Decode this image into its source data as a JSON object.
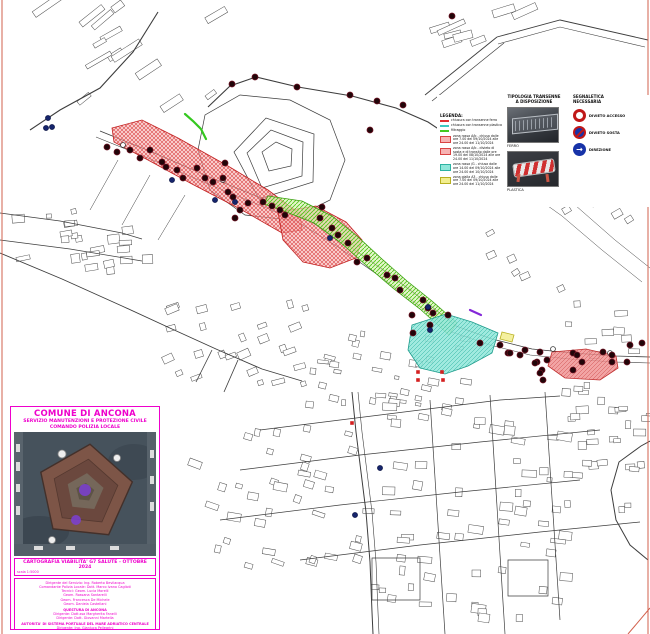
{
  "colors": {
    "magenta": "#ee00cc",
    "zone_red_hatch": "#d94343",
    "zone_green_hatch": "#55c41c",
    "zone_cyan": "#2db3a2",
    "zone_yellow": "#d8c820",
    "barrier_dot": "#210509",
    "blue_dot": "#15246b",
    "frame": "#d2604c"
  },
  "legend": {
    "col1_header": "TIPOLOGIA TRANSENNE\nA DISPOSIZIONE",
    "col2_header": "SEGNALETICA\nNECESSARIA",
    "list_title": "LEGENDA:",
    "items": [
      {
        "kind": "line",
        "color": "#e03030",
        "label": "chiusura con transenne ferro"
      },
      {
        "kind": "line",
        "color": "#3ec8c0",
        "label": "chiusura con transenne plastica"
      },
      {
        "kind": "line",
        "color": "#44c820",
        "label": "filtraggio"
      },
      {
        "kind": "zone",
        "color": "#f7b3b3",
        "border": "#d94343",
        "label": "zona rossa A/b - chiusa dalle ore 7.00 del 09/10/2024 alle ore 24.00 del 11/10/2024"
      },
      {
        "kind": "zone",
        "color": "#f7b3b3",
        "border": "#d94343",
        "label": "zona rossa A/b - divieto di sosta e di transito dalle ore 19.00 del 08/10/2024 alle ore 24.00 del 11/10/2024"
      },
      {
        "kind": "zone",
        "color": "#8fe7da",
        "border": "#2db3a2",
        "label": "zona rossa /G - chiusa dalle ore 14.00 del 09/10/2024 alle ore 24.00 del 10/10/2024"
      },
      {
        "kind": "zone",
        "color": "#f2ee8e",
        "border": "#b8b020",
        "label": "zona gialla A3 - chiusa dalle ore 7.00 del 09/10/2024 alle ore 24.00 del 11/10/2024"
      }
    ],
    "photos": [
      {
        "label": "FERRO"
      },
      {
        "label": "PLASTICA"
      }
    ],
    "signs": [
      {
        "name": "divieto-accesso",
        "label": "DIVIETO ACCESSO"
      },
      {
        "name": "divieto-sosta",
        "label": "DIVIETO SOSTA"
      },
      {
        "name": "direzione",
        "label": "DIREZIONE"
      }
    ]
  },
  "title_box": {
    "line1": "COMUNE DI ANCONA",
    "line2": "SERVIZIO MANUTENZIONI E PROTEZIONE CIVILE",
    "line3": "COMANDO POLIZIA LOCALE",
    "caption": "CARTOGRAFIA VIABILITA' G7 SALUTE - OTTOBRE 2024",
    "scale": "scala 1:5000",
    "credits": [
      {
        "text": "Dirigente del Servizio: Ing. Roberto Bevilacqua",
        "bold": false
      },
      {
        "text": "Comandante Polizia Locale: Dott. Marco Ivano Caglioti",
        "bold": false
      },
      {
        "text": "Tecnici: Geom. Lucia Morelli",
        "bold": false
      },
      {
        "text": "Geom. Rossana Santarelli",
        "bold": false
      },
      {
        "text": "Geom. Francesca De Michele",
        "bold": false
      },
      {
        "text": "Geom. Daniela Castellani",
        "bold": false
      },
      {
        "text": "QUESTURA DI ANCONA",
        "bold": true
      },
      {
        "text": "Dirigente: Dott.ssa Margherita Fanelli",
        "bold": false
      },
      {
        "text": "Dirigente: Dott. Giovanni Martella",
        "bold": false
      },
      {
        "text": "AUTORITA' DI SISTEMA PORTUALE DEL MARE ADRIATICO CENTRALE",
        "bold": true
      },
      {
        "text": "Dirigente: Ing. Gianluca Pellegrini",
        "bold": false
      },
      {
        "text": "Tecnico: Geom. Marco Bragagnolo",
        "bold": false
      }
    ]
  },
  "map": {
    "zones": [
      {
        "name": "zona-rossa-a",
        "pattern": "patRed",
        "stroke": "#c22020",
        "points": "112,128 142,120 178,138 228,166 268,190 300,214 302,230 282,233 242,210 192,184 148,160 114,142"
      },
      {
        "name": "zona-rossa-b",
        "pattern": "patRed",
        "stroke": "#c22020",
        "points": "278,212 316,206 346,222 362,240 356,258 330,268 303,262 283,240"
      },
      {
        "name": "zona-verde",
        "pattern": "patGreen",
        "stroke": "#3aa010",
        "points": "268,196 302,201 332,216 357,236 382,259 407,281 432,301 457,323 449,335 420,309 394,289 367,266 341,243 314,223 284,211 264,204"
      },
      {
        "name": "zona-rossa-g-cyan",
        "pattern": "patCyan",
        "stroke": "#1f9c8c",
        "points": "412,325 446,314 472,322 498,333 492,353 468,366 445,374 420,368 408,350"
      },
      {
        "name": "zona-rossa-destra",
        "pattern": "patRedSolid",
        "stroke": "#c03030",
        "points": "552,352 586,349 616,356 618,368 600,380 565,378 548,366"
      },
      {
        "name": "zona-gialla",
        "pattern": "patYellow",
        "stroke": "#b8b020",
        "points": "502,332 514,335 512,342 500,339"
      }
    ],
    "roads": [
      {
        "points": "30,130 60,110 100,88 133,52 158,12",
        "w": 1.1
      },
      {
        "points": "208,107 230,86 256,77 298,87 352,96 396,108 428,122 458,142 472,162",
        "w": 1.1
      },
      {
        "points": "100,131 152,152 212,178 266,200 302,216",
        "w": 0.8
      },
      {
        "points": "96,137 148,158 208,184 262,206 298,222",
        "w": 0.6
      },
      {
        "points": "302,216 342,241 382,269 422,299 456,326 492,339 532,349 572,353 616,356 650,357",
        "w": 0.8
      },
      {
        "points": "298,222 338,247 378,275 418,305 452,332 490,345 530,355 570,359 614,362 650,363",
        "w": 0.6
      },
      {
        "points": "0,253 62,279 122,306 172,329 216,349 262,369 302,381",
        "w": 0.9
      },
      {
        "points": "212,350 196,382",
        "w": 0.8
      },
      {
        "points": "238,360 224,392",
        "w": 0.8
      },
      {
        "points": "648,560 630,545 616,520 611,490 619,462 641,446 650,441",
        "w": 1
      },
      {
        "points": "352,392 356,432 361,472 366,512 370,562 372,612 373,634",
        "w": 1
      },
      {
        "points": "358,392 362,432 367,472 372,512 376,562 378,612 379,634",
        "w": 0.6
      },
      {
        "points": "260,430 380,415 500,400 560,396",
        "w": 0.7
      },
      {
        "points": "240,470 360,455 480,442 600,430",
        "w": 0.7
      },
      {
        "points": "220,520 340,505 460,492 580,480",
        "w": 0.7
      },
      {
        "points": "300,560 420,545 540,532 640,522",
        "w": 0.7
      },
      {
        "points": "430,400 445,634",
        "w": 0.7
      },
      {
        "points": "490,395 505,634",
        "w": 0.7
      },
      {
        "points": "545,392 560,620",
        "w": 0.7
      },
      {
        "points": "0,213 60,221 122,233 142,239",
        "w": 0.7
      },
      {
        "points": "0,240 70,249 142,261",
        "w": 0.7
      },
      {
        "points": "470,162 520,186 562,216 602,250 642,282",
        "w": 0.5
      },
      {
        "points": "480,150 530,175 575,205 615,240 650,268",
        "w": 0.5
      },
      {
        "points": "425,95 497,37",
        "w": 0.9
      },
      {
        "points": "432,101 504,43",
        "w": 0.7
      },
      {
        "points": "497,37 560,20 648,40",
        "w": 0.9
      },
      {
        "points": "498,44 560,27 645,47",
        "w": 0.6
      },
      {
        "points": "118,160 90,210",
        "w": 0.5
      },
      {
        "points": "150,175 122,225",
        "w": 0.5
      },
      {
        "points": "185,195 158,240",
        "w": 0.5
      }
    ],
    "outlines": [
      {
        "points": "234,152 266,118 314,134 313,182 259,199"
      },
      {
        "points": "247,153 271,130 303,142 302,176 262,188"
      },
      {
        "points": "262,152 276,142 292,149 291,166 269,171"
      },
      {
        "points": "198,150 205,115 240,95 290,100 330,120 345,160 330,200 290,220 245,215 210,190 198,150"
      },
      {
        "points": "508,560 548,560 548,596 508,596 508,560"
      },
      {
        "points": "372,558 420,558 420,600 372,600 372,558"
      }
    ],
    "green_lines": [
      "185,114 193,121 201,129 206,139"
    ],
    "purple_lines": [
      "470,310 481,315"
    ],
    "frame_lines": [
      [
        2,
        0,
        2,
        634
      ],
      [
        648,
        0,
        648,
        634
      ],
      [
        650,
        608,
        628,
        634
      ]
    ],
    "dots": {
      "barrier": [
        [
          107,
          147
        ],
        [
          117,
          152
        ],
        [
          130,
          150
        ],
        [
          140,
          158
        ],
        [
          150,
          150
        ],
        [
          162,
          162
        ],
        [
          166,
          167
        ],
        [
          177,
          170
        ],
        [
          183,
          178
        ],
        [
          197,
          168
        ],
        [
          205,
          178
        ],
        [
          213,
          182
        ],
        [
          225,
          163
        ],
        [
          223,
          178
        ],
        [
          228,
          192
        ],
        [
          233,
          197
        ],
        [
          240,
          210
        ],
        [
          248,
          203
        ],
        [
          263,
          202
        ],
        [
          272,
          206
        ],
        [
          280,
          210
        ],
        [
          235,
          218
        ],
        [
          285,
          215
        ],
        [
          322,
          207
        ],
        [
          320,
          218
        ],
        [
          332,
          228
        ],
        [
          338,
          235
        ],
        [
          348,
          243
        ],
        [
          357,
          262
        ],
        [
          367,
          258
        ],
        [
          387,
          275
        ],
        [
          395,
          278
        ],
        [
          400,
          290
        ],
        [
          423,
          300
        ],
        [
          428,
          308
        ],
        [
          412,
          315
        ],
        [
          433,
          313
        ],
        [
          448,
          315
        ],
        [
          430,
          325
        ],
        [
          413,
          333
        ],
        [
          480,
          343
        ],
        [
          508,
          353
        ],
        [
          525,
          350
        ],
        [
          540,
          352
        ],
        [
          573,
          353
        ],
        [
          603,
          352
        ],
        [
          627,
          362
        ],
        [
          582,
          362
        ],
        [
          573,
          370
        ],
        [
          542,
          370
        ],
        [
          543,
          380
        ],
        [
          537,
          362
        ],
        [
          500,
          345
        ],
        [
          510,
          353
        ],
        [
          520,
          355
        ],
        [
          535,
          363
        ],
        [
          547,
          360
        ],
        [
          577,
          355
        ],
        [
          612,
          355
        ],
        [
          642,
          343
        ],
        [
          612,
          362
        ],
        [
          540,
          373
        ],
        [
          630,
          345
        ],
        [
          232,
          84
        ],
        [
          255,
          77
        ],
        [
          297,
          87
        ],
        [
          350,
          95
        ],
        [
          377,
          101
        ],
        [
          403,
          105
        ],
        [
          370,
          130
        ],
        [
          452,
          16
        ]
      ],
      "blue": [
        [
          48,
          118
        ],
        [
          52,
          127
        ],
        [
          46,
          128
        ],
        [
          172,
          180
        ],
        [
          215,
          200
        ],
        [
          235,
          202
        ],
        [
          330,
          238
        ],
        [
          428,
          307
        ],
        [
          430,
          330
        ],
        [
          380,
          468
        ],
        [
          355,
          515
        ]
      ],
      "white": [
        [
          123,
          145
        ],
        [
          223,
          180
        ],
        [
          610,
          353
        ],
        [
          553,
          349
        ]
      ],
      "red_squares": [
        [
          418,
          372
        ],
        [
          442,
          372
        ],
        [
          443,
          380
        ],
        [
          418,
          380
        ],
        [
          352,
          423
        ]
      ]
    },
    "districts": [
      {
        "name": "port-warehouses",
        "x": 30,
        "y": 5,
        "w": 190,
        "h": 110,
        "n": 14,
        "minw": 10,
        "maxw": 34,
        "minh": 4,
        "maxh": 8,
        "rot": -35
      },
      {
        "name": "left-strip",
        "x": 0,
        "y": 198,
        "w": 148,
        "h": 68,
        "n": 24,
        "minw": 5,
        "maxw": 14,
        "minh": 4,
        "maxh": 9,
        "rot": -8
      },
      {
        "name": "harbor-town",
        "x": 150,
        "y": 298,
        "w": 155,
        "h": 100,
        "n": 26,
        "minw": 5,
        "maxw": 13,
        "minh": 4,
        "maxh": 8,
        "rot": -20
      },
      {
        "name": "old-town",
        "x": 300,
        "y": 330,
        "w": 165,
        "h": 95,
        "n": 40,
        "minw": 4,
        "maxw": 11,
        "minh": 3,
        "maxh": 7,
        "rot": 10
      },
      {
        "name": "grid-west",
        "x": 180,
        "y": 420,
        "w": 185,
        "h": 145,
        "n": 36,
        "minw": 5,
        "maxw": 14,
        "minh": 4,
        "maxh": 8,
        "rot": 15
      },
      {
        "name": "grid-center",
        "x": 362,
        "y": 398,
        "w": 200,
        "h": 230,
        "n": 60,
        "minw": 5,
        "maxw": 15,
        "minh": 4,
        "maxh": 9,
        "rot": 5
      },
      {
        "name": "right-city",
        "x": 560,
        "y": 298,
        "w": 88,
        "h": 225,
        "n": 40,
        "minw": 5,
        "maxw": 13,
        "minh": 4,
        "maxh": 8,
        "rot": 0
      },
      {
        "name": "pier-ships",
        "x": 425,
        "y": 2,
        "w": 100,
        "h": 60,
        "n": 8,
        "minw": 14,
        "maxw": 30,
        "minh": 5,
        "maxh": 8,
        "rot": -20
      },
      {
        "name": "hillside",
        "x": 470,
        "y": 160,
        "w": 170,
        "h": 130,
        "n": 12,
        "minw": 6,
        "maxw": 12,
        "minh": 4,
        "maxh": 7,
        "rot": -30
      }
    ]
  }
}
